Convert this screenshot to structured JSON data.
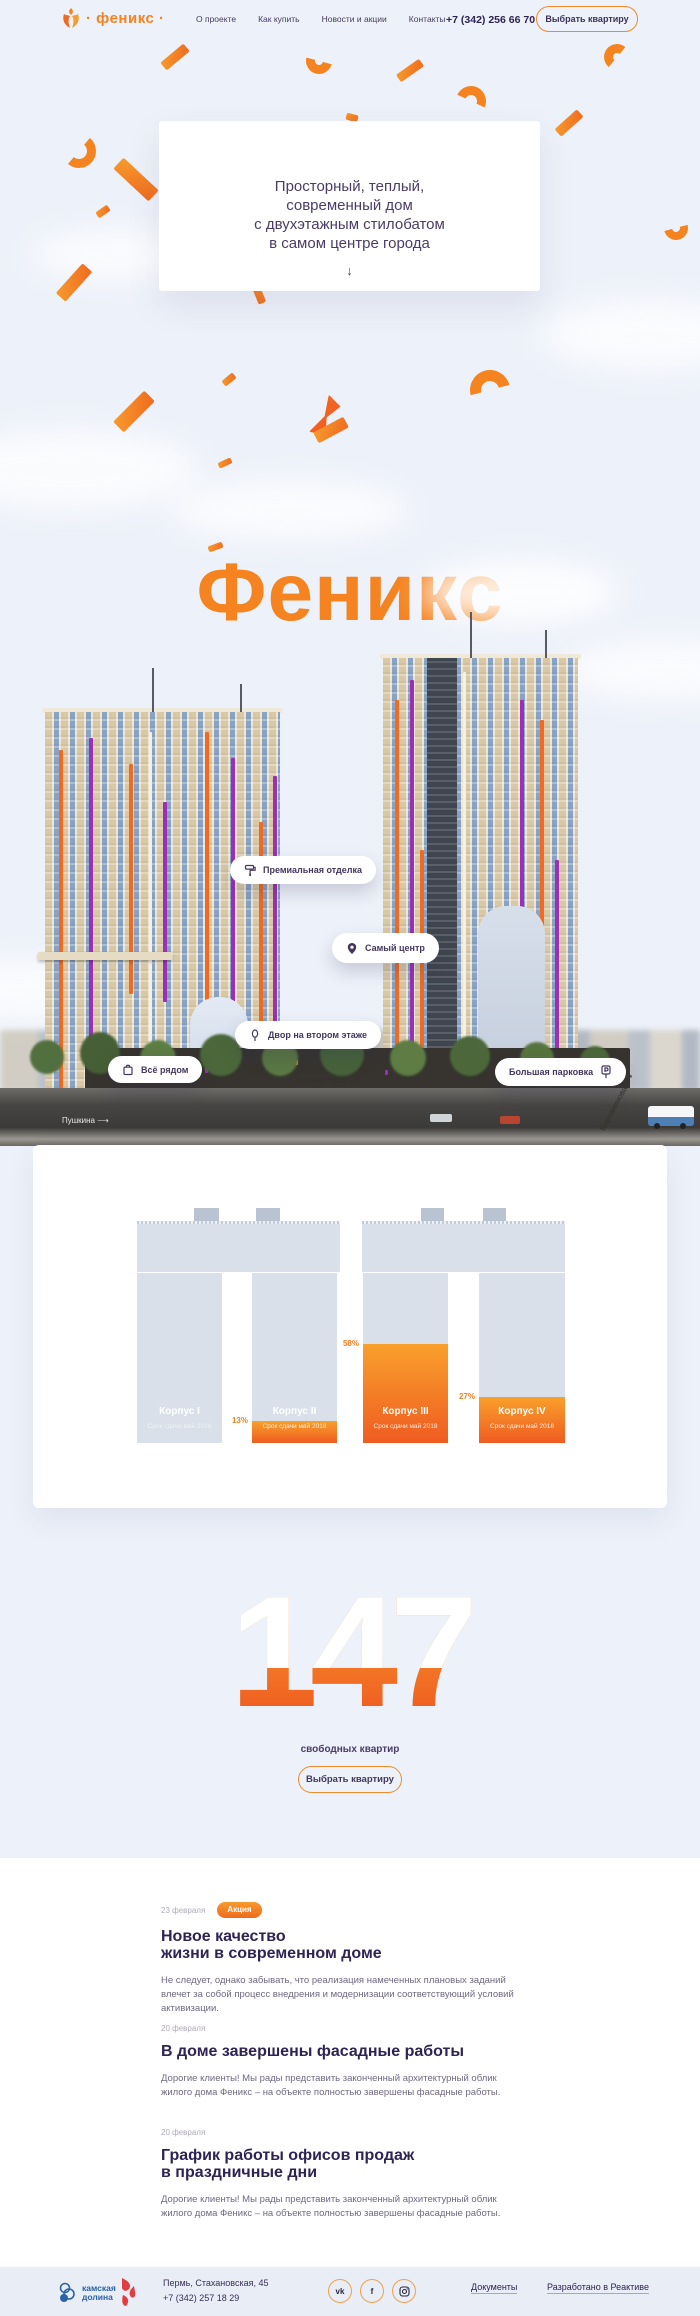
{
  "header": {
    "logo_text": "· феникс ·",
    "nav": [
      {
        "label": "О проекте"
      },
      {
        "label": "Как купить"
      },
      {
        "label": "Новости и акции"
      },
      {
        "label": "Контакты"
      }
    ],
    "phone": "+7 (342) 256 66 70",
    "cta_label": "Выбрать квартиру"
  },
  "hero": {
    "card_text": "Просторный, теплый,\nсовременный дом\nс двухэтажным стилобатом\nв самом центре города",
    "arrow": "↓",
    "big_title": "Феникс"
  },
  "building": {
    "pills": [
      {
        "icon": "paint-roller-icon",
        "label": "Премиальная отделка"
      },
      {
        "icon": "map-pin-icon",
        "label": "Самый центр"
      },
      {
        "icon": "tree-icon",
        "label": "Двор на втором этаже"
      },
      {
        "icon": "shopping-bag-icon",
        "label": "Всё рядом"
      },
      {
        "icon": "parking-icon",
        "label": "Большая парковка"
      }
    ],
    "street_labels": [
      {
        "label": "Пушкина ⟶"
      },
      {
        "label": "Луначарского ⟶"
      },
      {
        "label": "Борчанинова ⟶"
      }
    ]
  },
  "chart_data": {
    "type": "bar",
    "title": "",
    "categories": [
      "Корпус I",
      "Корпус II",
      "Корпус III",
      "Корпус IV"
    ],
    "values": [
      0,
      13,
      58,
      27
    ],
    "unit": "%",
    "value_labels": [
      "",
      "13%",
      "58%",
      "27%"
    ],
    "bar_subtitle": "Срок сдачи май 2018",
    "ylim": [
      0,
      100
    ],
    "colors": {
      "bar_bg": "#d9e0e9",
      "fill_top": "#f9a02c",
      "fill_bottom": "#ef5c21"
    }
  },
  "stats": {
    "number": "147",
    "caption": "свободных квартир",
    "cta_label": "Выбрать квартиру"
  },
  "news": {
    "items": [
      {
        "date": "23 февраля",
        "badge": "Акция",
        "title": "Новое качество\nжизни в современном доме",
        "body": "Не следует, однако забывать, что реализация намеченных плановых заданий влечет за собой процесс внедрения и модернизации соответствующий условий активизации."
      },
      {
        "date": "20 февраля",
        "title": "В доме завершены фасадные работы",
        "body": "Дорогие клиенты! Мы рады представить законченный архитектурный облик жилого дома Феникс – на объекте полностью завершены фасадные работы."
      },
      {
        "date": "20 февраля",
        "title": "График работы офисов продаж\nв праздничные дни",
        "body": "Дорогие клиенты! Мы рады представить законченный архитектурный облик жилого дома Феникс – на объекте полностью завершены фасадные работы."
      }
    ]
  },
  "footer": {
    "brand_line1": "камская",
    "brand_line2": "долина",
    "address_line1": "Пермь, Стахановская, 45",
    "address_line2": "+7 (342) 257 18 29",
    "socials": [
      {
        "icon": "vk-icon",
        "glyph": "vk"
      },
      {
        "icon": "facebook-icon",
        "glyph": "f"
      },
      {
        "icon": "instagram-icon",
        "glyph": ""
      }
    ],
    "links": [
      {
        "label": "Документы"
      },
      {
        "label": "Разработано в Реактиве"
      }
    ]
  },
  "colors": {
    "accent": "#f5831f",
    "accent_deep": "#ef5c21",
    "text_dark": "#2e2353",
    "text_purple": "#4a3c66",
    "sky": "#edf1f9",
    "footer_bg": "#e8edf6"
  }
}
